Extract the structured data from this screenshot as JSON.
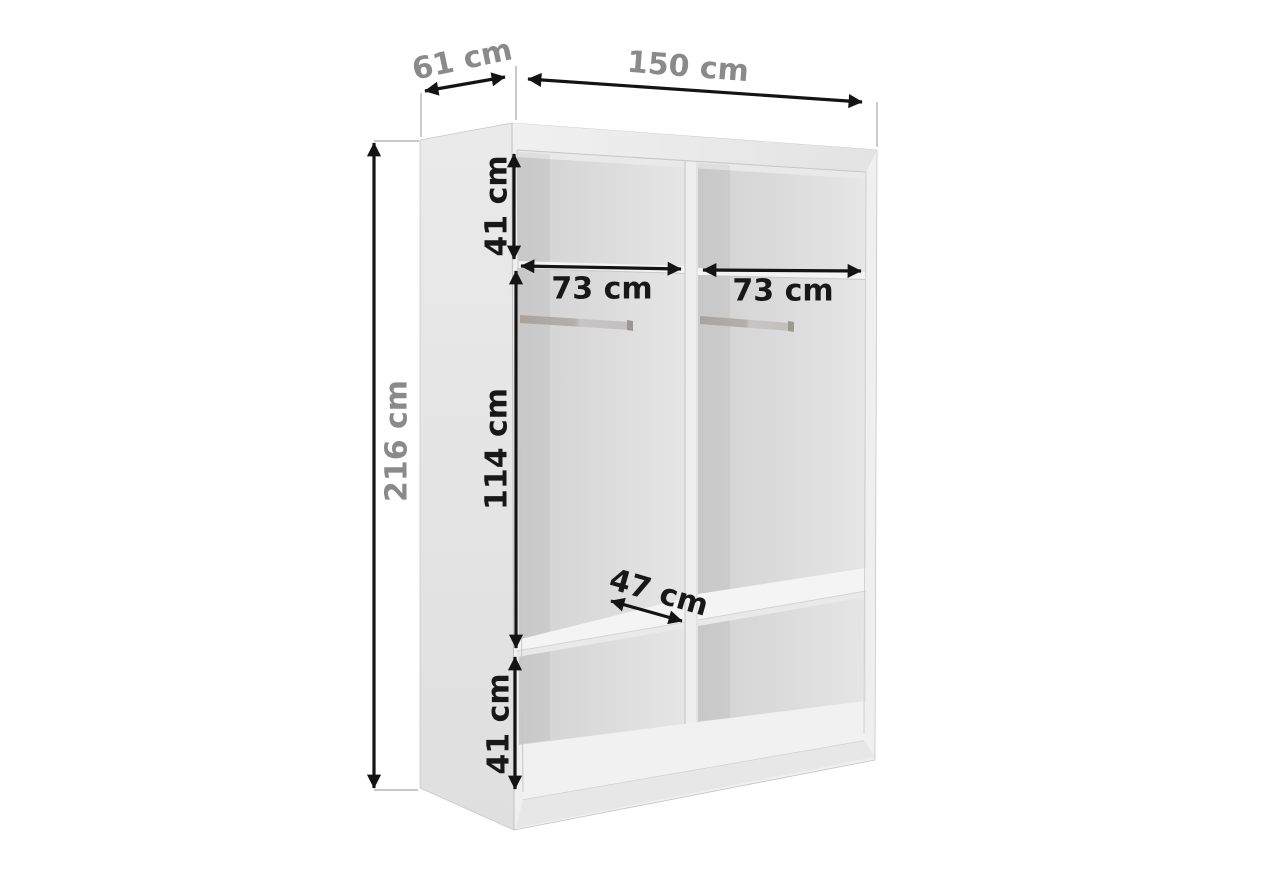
{
  "diagram": {
    "type": "wardrobe-dimension-diagram",
    "unit": "cm"
  },
  "dimensions": {
    "height": {
      "value": 216,
      "label": "216 cm"
    },
    "depth": {
      "value": 61,
      "label": "61 cm"
    },
    "width": {
      "value": 150,
      "label": "150 cm"
    },
    "top_section": {
      "value": 41,
      "label": "41 cm"
    },
    "left_compartment": {
      "value": 73,
      "label": "73 cm"
    },
    "right_compartment": {
      "value": 73,
      "label": "73 cm"
    },
    "hanging_section": {
      "value": 114,
      "label": "114 cm"
    },
    "shelf_depth": {
      "value": 47,
      "label": "47 cm"
    },
    "bottom_section": {
      "value": 41,
      "label": "41 cm"
    }
  },
  "style": {
    "background": "#ffffff",
    "dimension_line": "#141414",
    "outer_label": "#8a8a8a",
    "inner_label": "#181818",
    "cabinet_frame": "#efefef",
    "cabinet_side": "#e4e4e4",
    "interior_wall": "#d2d2d2",
    "shelf": "#f3f3f3",
    "rail": "#b0aaa5"
  }
}
